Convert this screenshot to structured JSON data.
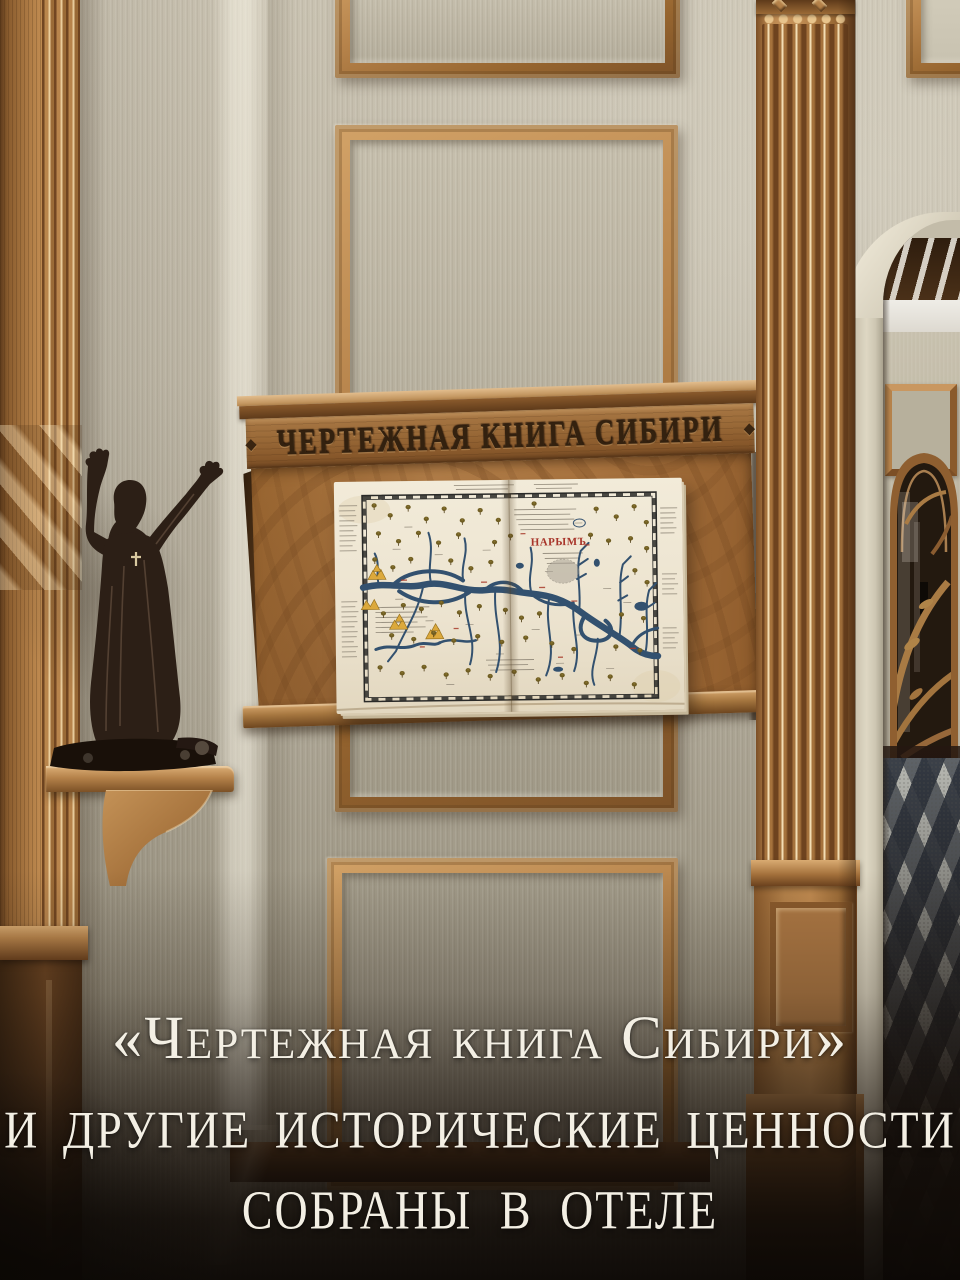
{
  "scene": {
    "description": "hotel hallway with carved lectern displaying an antique map of Siberia"
  },
  "caption": {
    "line1": "«Чертежная книга Сибири»",
    "line2": "и другие исторические ценности",
    "line3": "собраны в отеле"
  },
  "lectern": {
    "carved_title": "ЧЕРТЕЖНАЯ КНИГА СИБИРИ",
    "ornament": "◆"
  },
  "map": {
    "label_red": "НАРЫМЪ"
  },
  "palette": {
    "wallpaper": "#c2bbaa",
    "wood": "#b07c46",
    "wood_dark": "#6e451f",
    "bronze": "#2c1f16",
    "paper": "#efe7d4",
    "river": "#33516f",
    "floor_dark": "#3a4048",
    "floor_light": "#b9bab2",
    "caption_text": "#f3efe4"
  }
}
